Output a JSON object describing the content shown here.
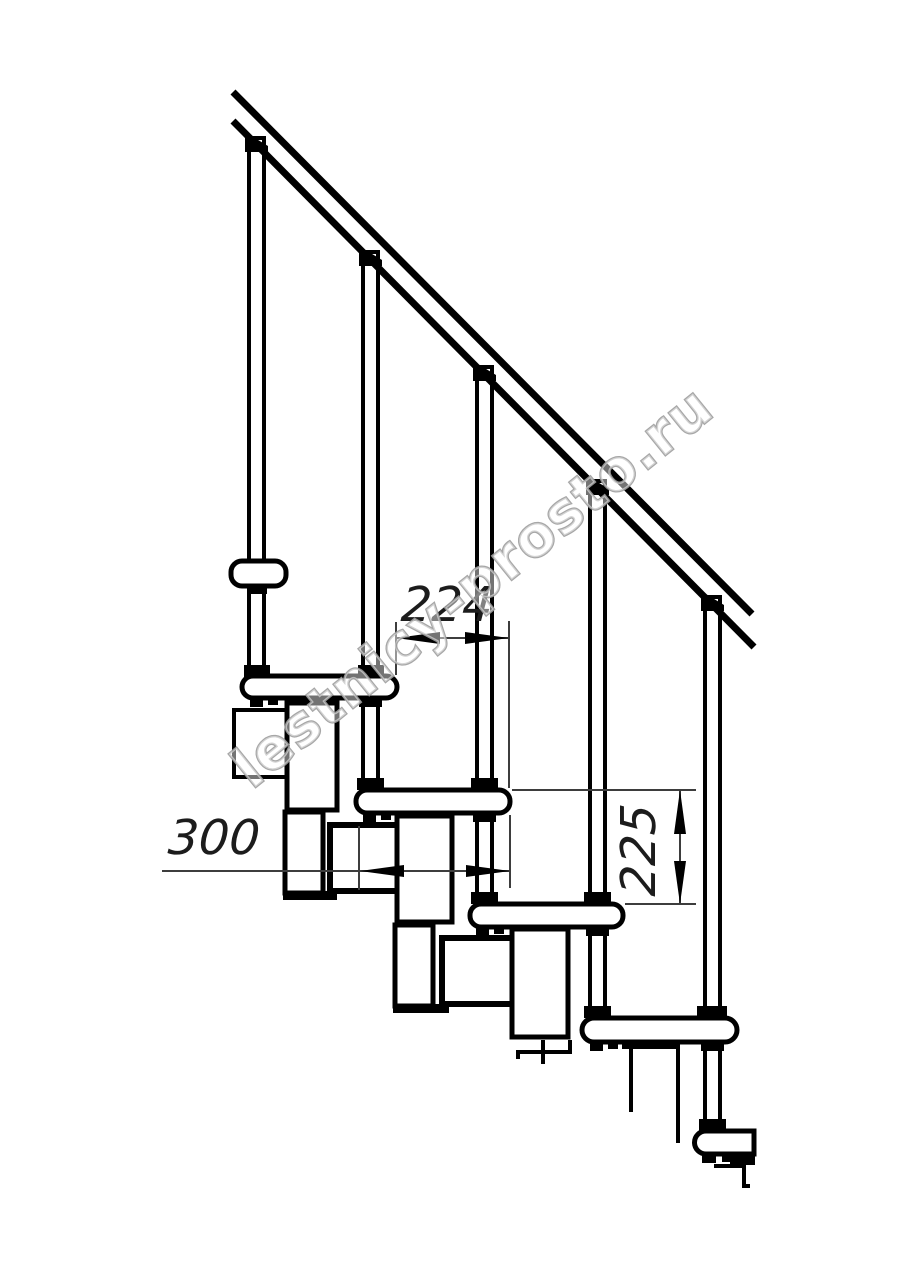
{
  "drawing": {
    "kind": "staircase-side-view",
    "dimensions": {
      "run": "224",
      "tread_width": "300",
      "riser_height": "225"
    },
    "watermark": {
      "text": "lestnicy-prosto.ru"
    },
    "colors": {
      "line": "#000000",
      "dimension": "#3d3d3d",
      "background": "#ffffff",
      "watermark_stroke": "#9e9e9e"
    }
  }
}
